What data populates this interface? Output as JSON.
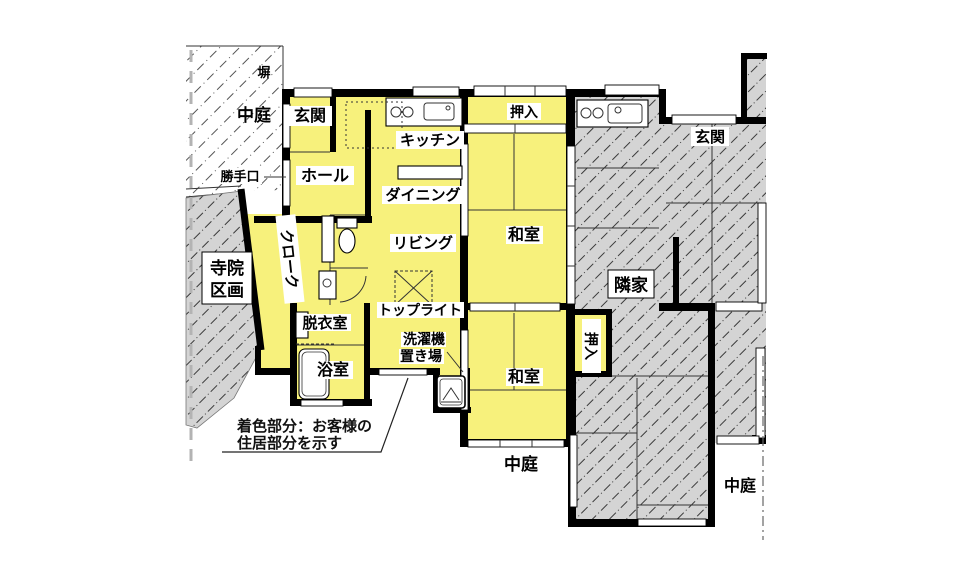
{
  "labels": {
    "fence": "塀",
    "courtyard_top_left": "中庭",
    "courtyard_bottom": "中庭",
    "courtyard_bottom_right": "中庭",
    "temple_line1": "寺院",
    "temple_line2": "区画",
    "back_door": "勝手口",
    "entrance_main": "玄関",
    "hall": "ホール",
    "kitchen": "キッチン",
    "dining": "ダイニング",
    "living": "リビング",
    "cloak": "クローク",
    "closet_top": "押入",
    "tatami_upper": "和室",
    "tatami_lower": "和室",
    "closet_side": "押入",
    "dressing_room": "脱衣室",
    "bathroom": "浴室",
    "skylight": "トップライト",
    "washer_line1": "洗濯機",
    "washer_line2": "置き場",
    "neighbor_house": "隣家",
    "entrance_neighbor": "玄関",
    "note_line1": "着色部分：お客様の",
    "note_line2": "住居部分を示す"
  },
  "colors": {
    "residence_fill": "#F7F17C",
    "neighbor_fill": "#D4D4D4",
    "wall": "#000000",
    "background": "#FFFFFF"
  }
}
